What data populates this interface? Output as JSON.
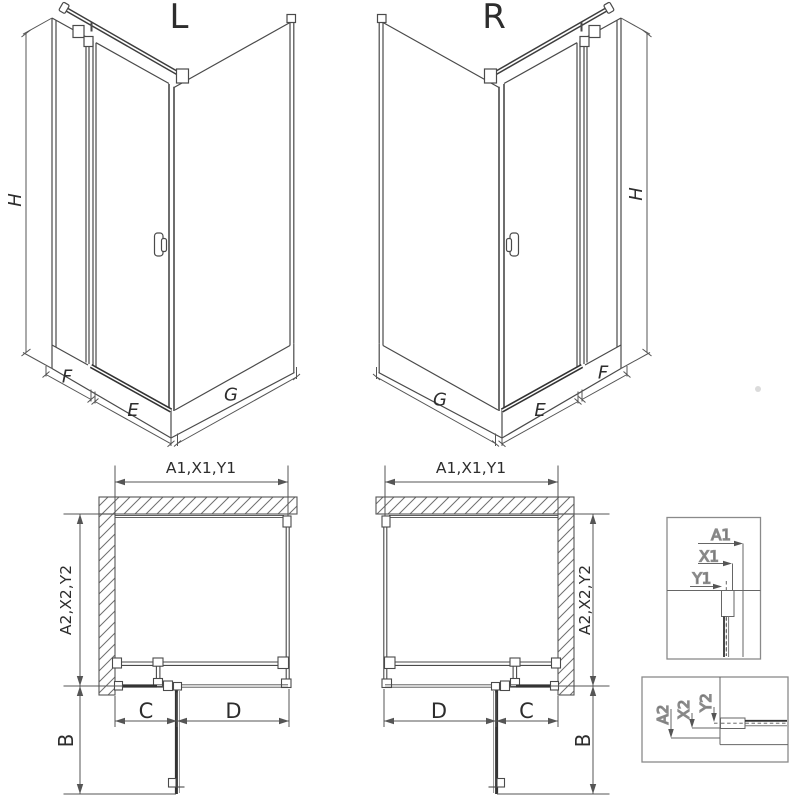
{
  "iso_left": {
    "title": "L",
    "height_label": "H",
    "side_panel_label": "F",
    "door_label": "E",
    "wall_label": "G"
  },
  "iso_right": {
    "title": "R",
    "height_label": "H",
    "side_panel_label": "F",
    "door_label": "E",
    "wall_label": "G"
  },
  "plan_left": {
    "width_label": "A1,X1,Y1",
    "depth_label": "A2,X2,Y2",
    "door_swing_label": "B",
    "c_label": "C",
    "d_label": "D"
  },
  "plan_right": {
    "width_label": "A1,X1,Y1",
    "depth_label": "A2,X2,Y2",
    "door_swing_label": "B",
    "c_label": "C",
    "d_label": "D"
  },
  "detail_top": {
    "a1": "A1",
    "x1": "X1",
    "y1": "Y1"
  },
  "detail_bottom": {
    "a2": "A2",
    "x2": "X2",
    "y2": "Y2"
  },
  "colors": {
    "line": "#4a4a4a",
    "dark_line": "#333333",
    "dim_line": "#555555",
    "text": "#2d2d2d",
    "hatch": "#6f6f6f",
    "box_border": "#8a8a8a",
    "background": "#ffffff"
  }
}
